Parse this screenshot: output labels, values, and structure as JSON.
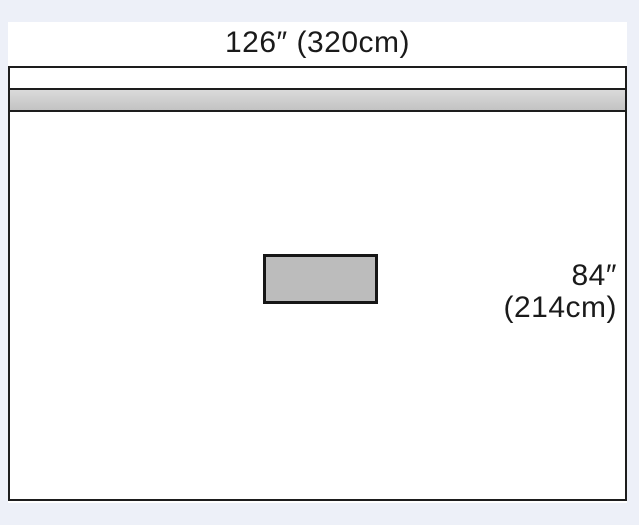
{
  "diagram": {
    "width_label": "126″ (320cm)",
    "height_label_inches": "84″",
    "height_label_cm": "(214cm)"
  },
  "colors": {
    "page_background": "#edf0f8",
    "figure_background": "#ffffff",
    "outline": "#1d1d1d",
    "adhesive_band_fill": "#c9c9c9",
    "fenestration_fill": "#bcbcbc"
  }
}
